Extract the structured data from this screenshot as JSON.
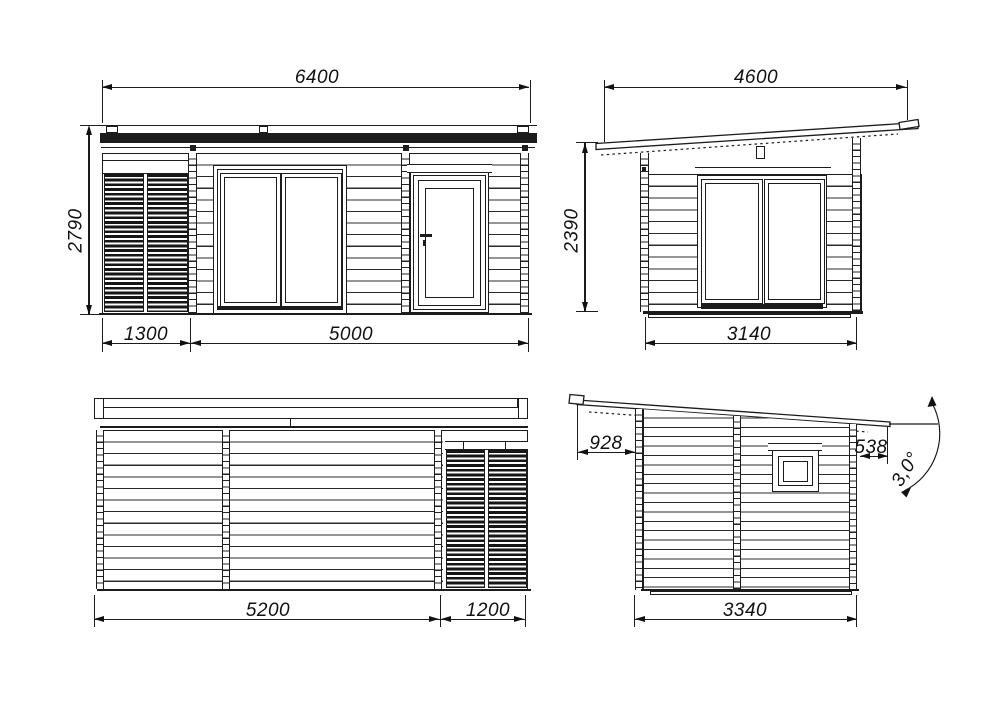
{
  "drawing": {
    "background": "#ffffff",
    "line_color": "#1c1c1c",
    "views": {
      "front": {
        "dims": {
          "total_width": "6400",
          "total_height": "2790",
          "left_width": "1300",
          "right_width": "5000"
        }
      },
      "right_side": {
        "dims": {
          "roof_length": "4600",
          "wall_height": "2390",
          "width": "3140"
        }
      },
      "rear": {
        "dims": {
          "left_width": "5200",
          "right_width": "1200"
        }
      },
      "left_side": {
        "dims": {
          "left_overhang": "928",
          "right_overhang": "538",
          "roof_angle": "3,0°",
          "width": "3340"
        }
      }
    }
  }
}
